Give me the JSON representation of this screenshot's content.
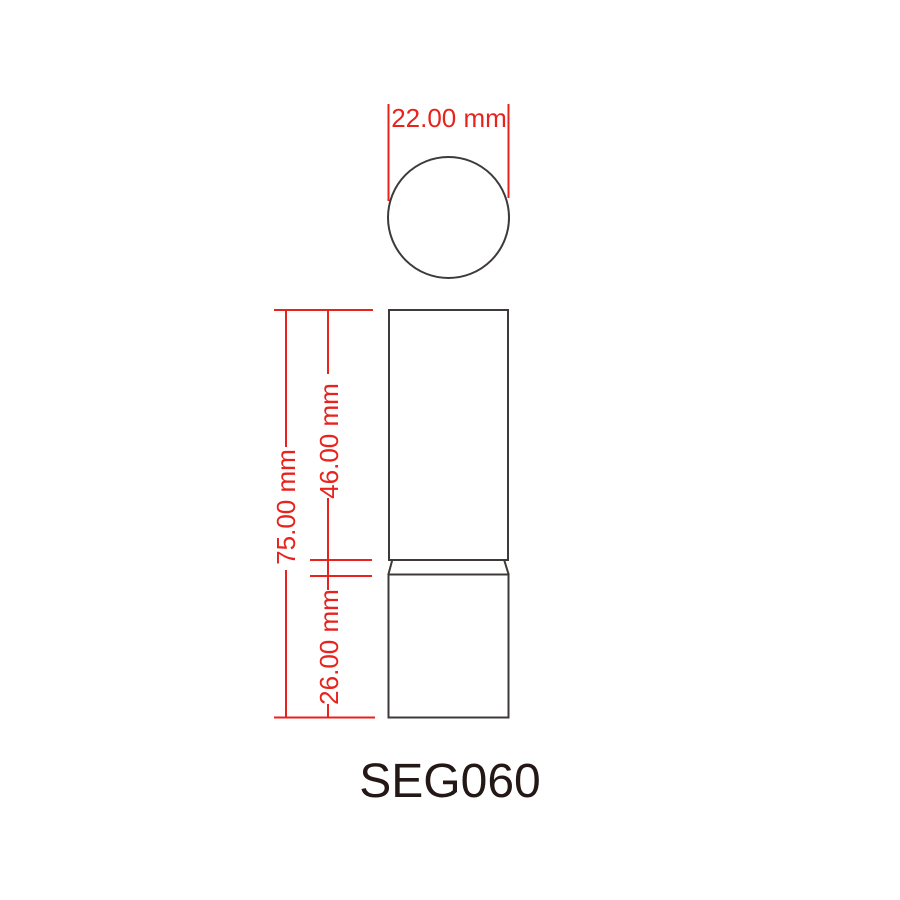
{
  "drawing": {
    "title": "SEG060",
    "type": "packaging-technical-drawing",
    "views": {
      "top_view": {
        "shape": "circle",
        "description": "top view of round lipstick tube"
      },
      "front_view": {
        "parts": [
          "cap",
          "neck",
          "base"
        ]
      }
    },
    "dimensions": {
      "diameter": {
        "label": "22.00 mm"
      },
      "total_height": {
        "label": "75.00 mm"
      },
      "cap_height": {
        "label": "46.00 mm"
      },
      "base_height": {
        "label": "26.00 mm"
      }
    },
    "colors": {
      "dimension": "#e8231d",
      "outline": "#3e3a39",
      "title": "#231815",
      "background": "#ffffff"
    }
  }
}
